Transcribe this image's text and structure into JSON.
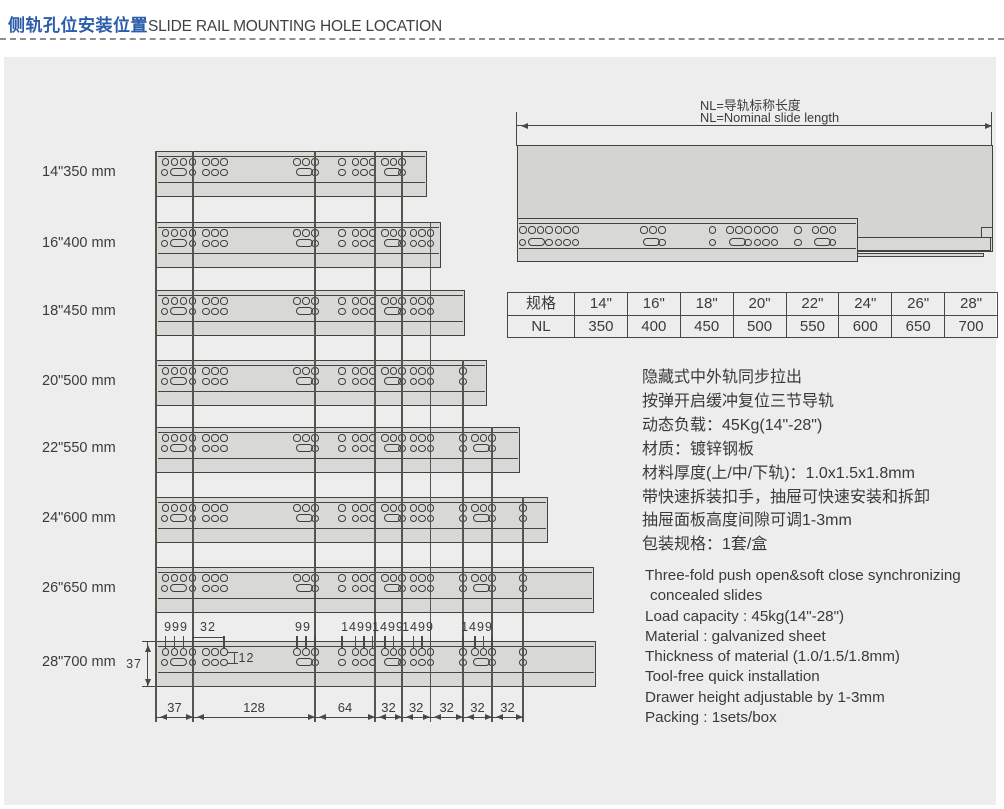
{
  "header": {
    "title_zh": "侧轨孔位安装位置",
    "title_en": "SLIDE RAIL MOUNTING HOLE LOCATION"
  },
  "colors": {
    "accent_blue": "#2a5caa",
    "panel_bg": "#ecedec",
    "rail_fill": "#d8d9d6",
    "line_dark": "#44423f",
    "text_dark": "#3b3b3b"
  },
  "rail_rows": [
    {
      "label": "14\"350 mm"
    },
    {
      "label": "16\"400 mm"
    },
    {
      "label": "18\"450 mm"
    },
    {
      "label": "20\"500 mm"
    },
    {
      "label": "22\"550 mm"
    },
    {
      "label": "24\"600 mm"
    },
    {
      "label": "26\"650 mm"
    },
    {
      "label": "28\"700 mm"
    }
  ],
  "assembled": {
    "note_zh": "NL=导轨标称长度",
    "note_en": "NL=Nominal slide length"
  },
  "size_table": {
    "header_row": [
      "规格",
      "14\"",
      "16\"",
      "18\"",
      "20\"",
      "22\"",
      "24\"",
      "26\"",
      "28\""
    ],
    "nl_row": [
      "NL",
      "350",
      "400",
      "450",
      "500",
      "550",
      "600",
      "650",
      "700"
    ]
  },
  "dimensions": {
    "top_labels": [
      "999",
      "32",
      "99",
      "1499",
      "1499",
      "1499",
      "1499"
    ],
    "row_gap": "12",
    "rail_height": "37",
    "bottom_labels": [
      "37",
      "128",
      "64",
      "32",
      "32",
      "32",
      "32",
      "32"
    ]
  },
  "specs_zh": [
    "隐藏式中外轨同步拉出",
    "按弹开启缓冲复位三节导轨",
    "动态负载：45Kg(14\"-28\")",
    "材质：镀锌钢板",
    "材料厚度(上/中/下轨)：1.0x1.5x1.8mm",
    "带快速拆装扣手，抽屉可快速安装和拆卸",
    "抽屉面板高度间隙可调1-3mm",
    "包装规格：1套/盒"
  ],
  "specs_en": [
    "Three-fold push open&soft close synchronizing",
    "concealed slides",
    "Load capacity : 45kg(14\"-28\")",
    "Material : galvanized sheet",
    "Thickness of material (1.0/1.5/1.8mm)",
    "Tool-free quick installation",
    "Drawer height adjustable by 1-3mm",
    "Packing : 1sets/box"
  ]
}
